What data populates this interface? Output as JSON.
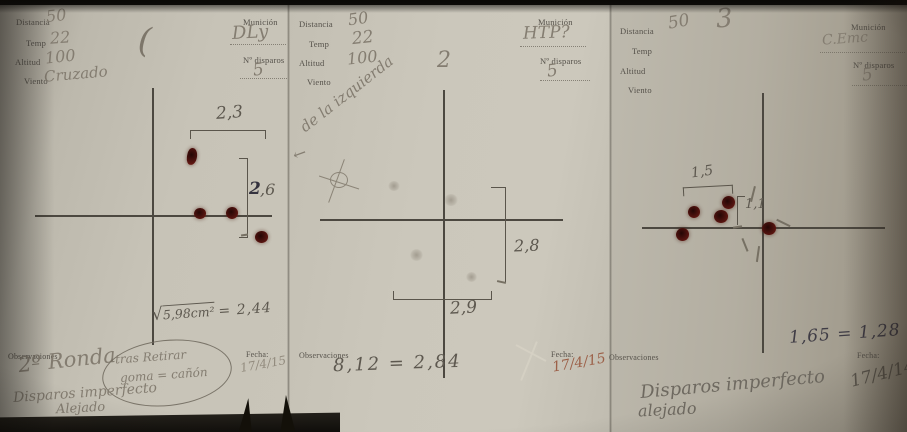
{
  "document_type": "shooting-target-record-sheets",
  "colors": {
    "paper": "#c7c3b7",
    "pencil": "#847d71",
    "pencil_dark": "#5d584f",
    "ink_dark": "#34323e",
    "bullet_hole": "#4e120e",
    "date_red": "#9c6048",
    "form_print": "#55514a"
  },
  "panels": [
    {
      "fields": {
        "distancia": {
          "label": "Distancia",
          "value": "50"
        },
        "temp": {
          "label": "Temp",
          "value": "22"
        },
        "altitud": {
          "label": "Altitud",
          "value": "100"
        },
        "viento": {
          "label": "Viento",
          "value": "Cruzado"
        },
        "municion": {
          "label": "Munición",
          "value": "DLy"
        },
        "disparos": {
          "label": "Nº disparos",
          "value": "5"
        }
      },
      "stray_mark": "(",
      "measure_h": "2,3",
      "measure_v_bold": "2",
      "measure_v_rest": ",6",
      "formula_radical": "√",
      "formula_radicand": "5,98cm²",
      "formula_result": "= 2,44",
      "obs_label": "Observaciones",
      "obs_big": "2º Ronda",
      "obs_paren_l1": "tras Retirar",
      "obs_paren_l2": "goma = cañón",
      "obs_l2": "Disparos imperfecto",
      "obs_l3": "Alejado",
      "fecha_label": "Fecha:",
      "fecha": "17/4/15"
    },
    {
      "fields": {
        "distancia": {
          "label": "Distancia",
          "value": "50"
        },
        "temp": {
          "label": "Temp",
          "value": "22"
        },
        "altitud": {
          "label": "Altitud",
          "value": "100"
        },
        "viento": {
          "label": "Viento",
          "value": ""
        },
        "municion": {
          "label": "Munición",
          "value": "HTP?"
        },
        "disparos": {
          "label": "Nº disparos",
          "value": "5"
        }
      },
      "stray_mark": "2",
      "note_arrow": "←",
      "note": "de la izquierda",
      "measure_v": "2,8",
      "measure_h": "2,9",
      "obs_label": "Observaciones",
      "obs_formula": "8,12 = 2,84",
      "fecha_label": "Fecha:",
      "fecha": "17/4/15"
    },
    {
      "fields": {
        "distancia": {
          "label": "Distancia",
          "value": "50"
        },
        "temp": {
          "label": "Temp",
          "value": ""
        },
        "altitud": {
          "label": "Altitud",
          "value": ""
        },
        "viento": {
          "label": "Viento",
          "value": ""
        },
        "municion": {
          "label": "Munición",
          "value": "C.Emc"
        },
        "disparos": {
          "label": "Nº disparos",
          "value": "5"
        }
      },
      "stray_mark": "3",
      "measure_h": "1,5",
      "measure_v": "1,1",
      "result": "1,65 = 1,28",
      "obs_label": "Observaciones",
      "obs_l1": "Disparos imperfecto",
      "obs_l2": "alejado",
      "fecha_label": "Fecha:",
      "fecha": "17/4/14"
    }
  ]
}
